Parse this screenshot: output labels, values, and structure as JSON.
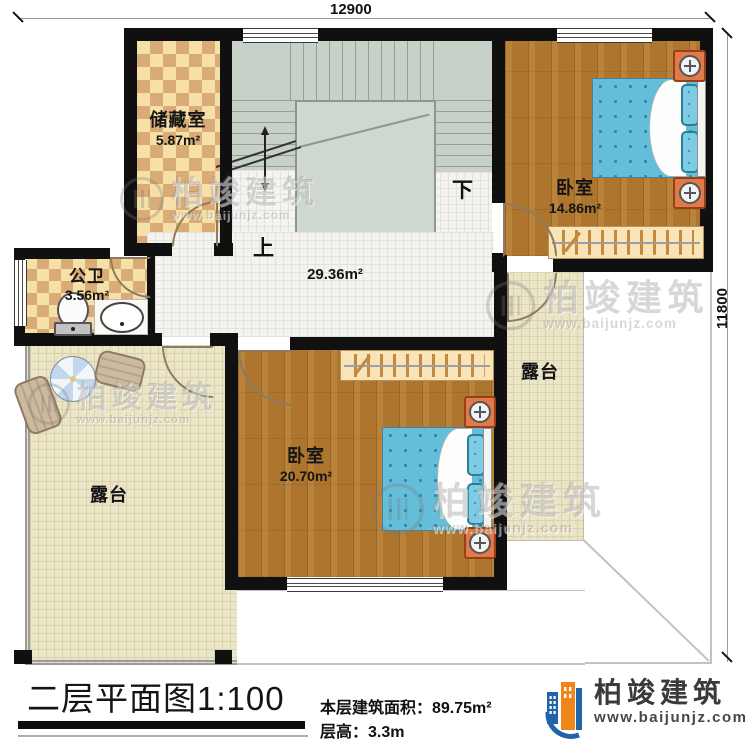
{
  "floorplan": {
    "title": "二层平面图1:100",
    "stats": {
      "floor_area": "本层建筑面积：89.75m²",
      "floor_height": "层高：3.3m"
    },
    "dimensions": {
      "top": "12900",
      "right": "11800"
    },
    "rooms": {
      "storage": {
        "name": "储藏室",
        "area": "5.87m²"
      },
      "bathroom": {
        "name": "公卫",
        "area": "3.56m²"
      },
      "bedroom_top_right": {
        "name": "卧室",
        "area": "14.86m²"
      },
      "bedroom_bottom": {
        "name": "卧室",
        "area": "20.70m²"
      },
      "hall": {
        "area": "29.36m²"
      },
      "terrace_left": {
        "name": "露台"
      },
      "terrace_right": {
        "name": "露台"
      }
    },
    "stairs": {
      "up_label": "上",
      "down_label": "下"
    },
    "branding": {
      "company": "柏竣建筑",
      "website": "www.baijunjz.com"
    },
    "colors": {
      "wall": "#101010",
      "wood_floor": "#ad752e",
      "bed_blue": "#64bed9",
      "stair_green": "#c7d1c8",
      "logo_blue": "#2264a8",
      "logo_orange": "#f08519"
    }
  }
}
